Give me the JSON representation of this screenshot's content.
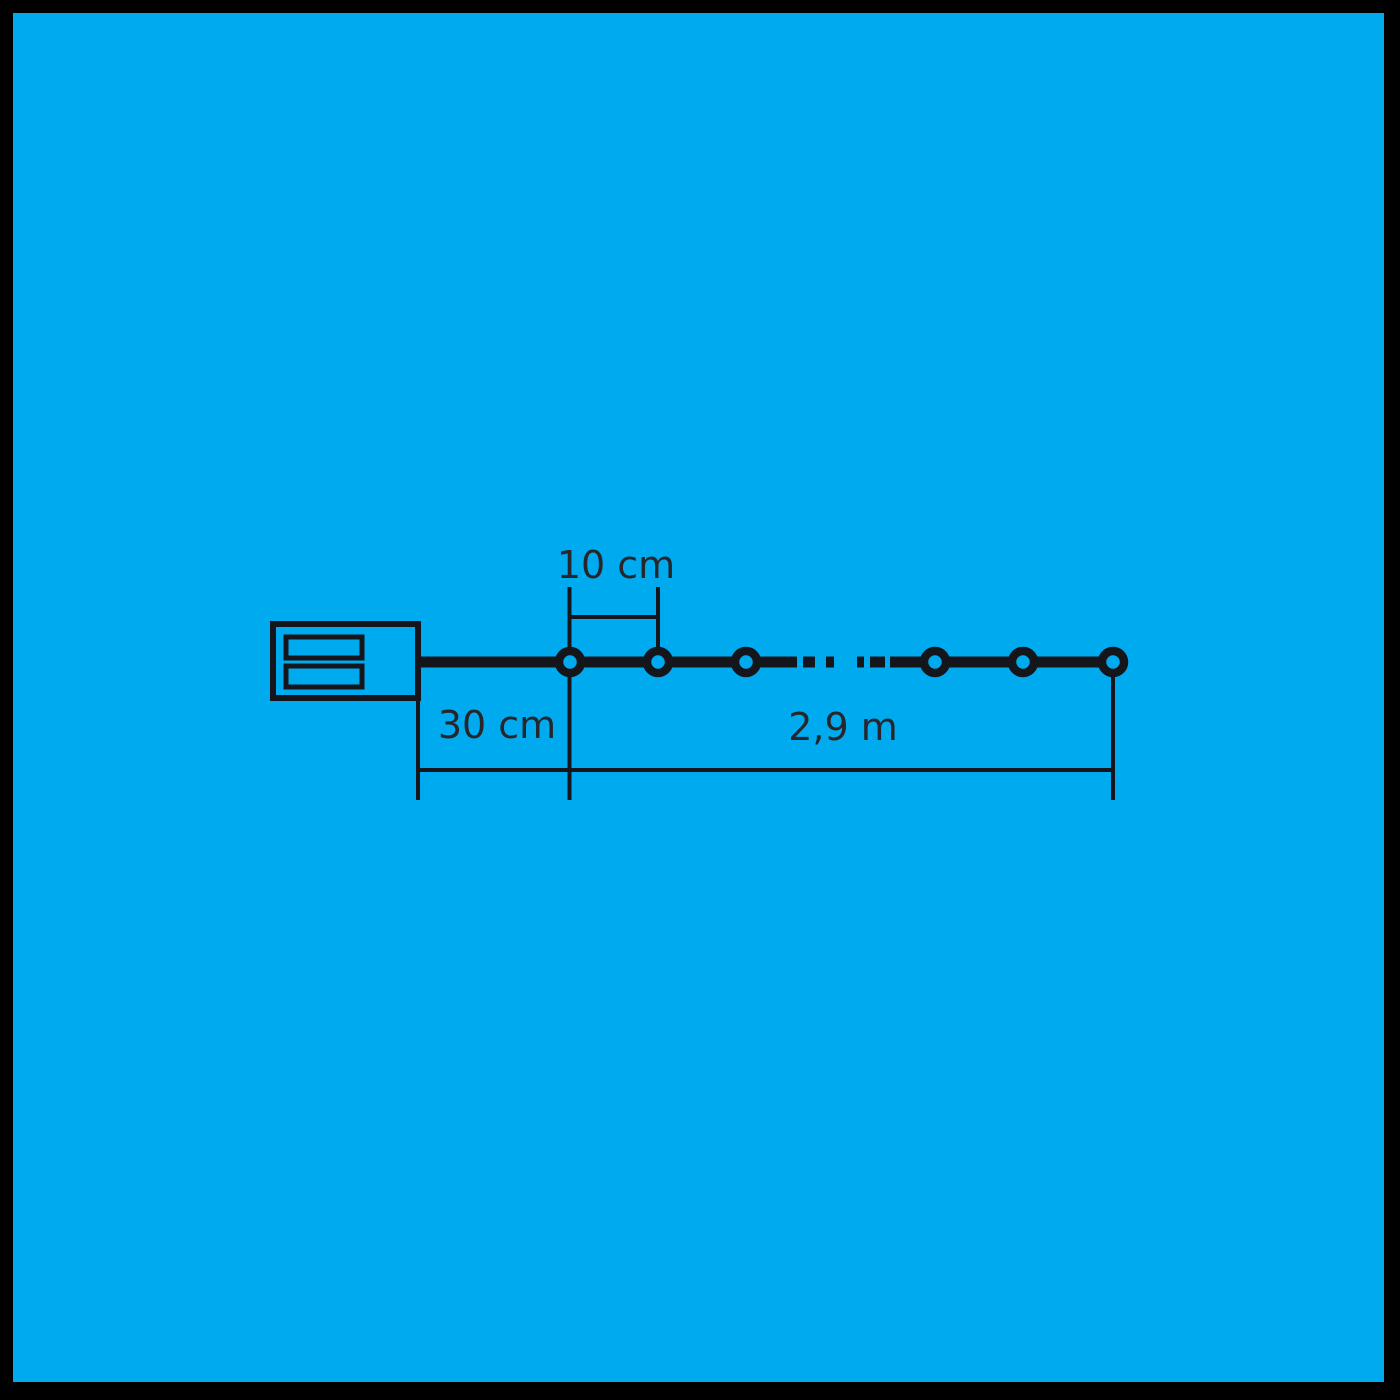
{
  "colors": {
    "frame": "#000000",
    "background": "#00aaee",
    "line": "#14161b",
    "text": "#26262b"
  },
  "diagram": {
    "description": "light-string-dimension-diagram",
    "bulbs_visible": 6,
    "dimensions": {
      "bulb_spacing_label": "10 cm",
      "lead_length_label": "30 cm",
      "lit_length_label": "2,9 m"
    }
  }
}
